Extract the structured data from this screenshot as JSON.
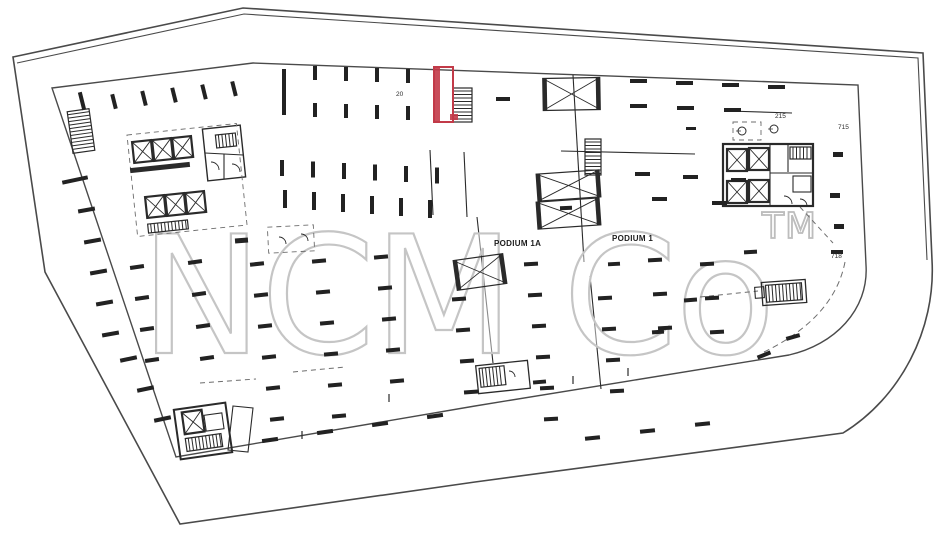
{
  "title": "Podium level floor plan (scanned drawing)",
  "watermark": {
    "text": "NCM Co",
    "tm": "TM"
  },
  "labels": {
    "podium1a": "PODIUM 1A",
    "podium1": "PODIUM 1"
  },
  "colors": {
    "ink": "#2a2a2a",
    "boundary": "#4a4a4a",
    "faint": "#6d6d6d",
    "red": "#c23a48",
    "watermark": "#c5c5c5"
  },
  "tiny_labels": [
    {
      "t": "20",
      "x": 396,
      "y": 96
    },
    {
      "t": "215",
      "x": 775,
      "y": 118
    },
    {
      "t": "715",
      "x": 838,
      "y": 129
    },
    {
      "t": "718",
      "x": 831,
      "y": 258
    }
  ],
  "plan": {
    "outer": "M13,57 L243,8 L923,53 L932,260 C936,330 900,398 843,433 L475,482 L180,524 L45,272 Z",
    "outerDouble": "M17,63 L244,14 L918,58 L927,260",
    "inner": "M52,88 L253,63 L858,85 L866,265 C869,310 834,345 789,355 L475,406 L176,457 Z",
    "aisle_lines": [
      [
        573,
        75,
        584,
        262
      ],
      [
        477,
        217,
        493,
        363
      ],
      [
        590,
        276,
        601,
        389
      ],
      [
        561,
        151,
        695,
        154
      ],
      [
        728,
        111,
        792,
        113
      ],
      [
        430,
        150,
        433,
        215
      ],
      [
        464,
        152,
        467,
        217
      ]
    ],
    "dashed_lines": [
      [
        293,
        372,
        345,
        367
      ],
      [
        200,
        383,
        256,
        379
      ],
      [
        800,
        207,
        833,
        243
      ],
      [
        700,
        297,
        758,
        291
      ],
      [
        736,
        131,
        742,
        131
      ],
      [
        768,
        129,
        774,
        129
      ]
    ],
    "dashed_arc": "M845,262 Q834,318 764,352",
    "stubs": [
      [
        302,
        431,
        302,
        439
      ],
      [
        389,
        394,
        389,
        402
      ],
      [
        573,
        376,
        573,
        384
      ],
      [
        628,
        368,
        628,
        376
      ]
    ],
    "red_room": {
      "x": 434,
      "y": 67,
      "w": 19,
      "h": 55
    },
    "ramps": [
      {
        "x": 543,
        "y": 78,
        "w": 57,
        "h": 32,
        "rot": -1
      },
      {
        "x": 537,
        "y": 172,
        "w": 63,
        "h": 27,
        "rot": -4
      },
      {
        "x": 537,
        "y": 200,
        "w": 63,
        "h": 27,
        "rot": -4
      },
      {
        "x": 455,
        "y": 257,
        "w": 50,
        "h": 30,
        "rot": -8
      }
    ],
    "stairs": [
      {
        "x": 70,
        "y": 110,
        "w": 22,
        "h": 42,
        "rot": -8
      },
      {
        "x": 453,
        "y": 88,
        "w": 19,
        "h": 34,
        "rot": 0
      },
      {
        "x": 585,
        "y": 139,
        "w": 16,
        "h": 36,
        "rot": 0
      },
      {
        "x": 216,
        "y": 134,
        "w": 20,
        "h": 13,
        "rot": -6
      },
      {
        "x": 790,
        "y": 147,
        "w": 21,
        "h": 12,
        "rot": 0
      },
      {
        "x": 480,
        "y": 367,
        "w": 25,
        "h": 19,
        "rot": -6
      },
      {
        "x": 766,
        "y": 284,
        "w": 36,
        "h": 17,
        "rot": -4
      },
      {
        "x": 186,
        "y": 436,
        "w": 36,
        "h": 13,
        "rot": -8
      },
      {
        "x": 148,
        "y": 222,
        "w": 40,
        "h": 9,
        "rot": -6
      }
    ],
    "elevators": [
      {
        "x": 133,
        "y": 141,
        "s": 19,
        "rot": -6
      },
      {
        "x": 153,
        "y": 139,
        "s": 19,
        "rot": -6
      },
      {
        "x": 173,
        "y": 137,
        "s": 19,
        "rot": -6
      },
      {
        "x": 146,
        "y": 196,
        "s": 19,
        "rot": -6
      },
      {
        "x": 166,
        "y": 194,
        "s": 19,
        "rot": -6
      },
      {
        "x": 186,
        "y": 192,
        "s": 19,
        "rot": -6
      },
      {
        "x": 727,
        "y": 149,
        "s": 20,
        "rot": 0
      },
      {
        "x": 749,
        "y": 148,
        "s": 20,
        "rot": 0
      },
      {
        "x": 727,
        "y": 181,
        "s": 20,
        "rot": 0
      },
      {
        "x": 749,
        "y": 180,
        "s": 20,
        "rot": 0
      },
      {
        "x": 183,
        "y": 411,
        "s": 20,
        "rot": -8
      }
    ],
    "rects": [
      {
        "x": 205,
        "y": 127,
        "w": 38,
        "h": 52,
        "rot": -6,
        "sw": 1.4
      },
      {
        "x": 723,
        "y": 144,
        "w": 90,
        "h": 62,
        "rot": 0,
        "sw": 2.2
      },
      {
        "x": 793,
        "y": 176,
        "w": 18,
        "h": 16,
        "rot": 0,
        "sw": 1.1
      },
      {
        "x": 177,
        "y": 406,
        "w": 52,
        "h": 50,
        "rot": -8,
        "sw": 2
      },
      {
        "x": 205,
        "y": 414,
        "w": 18,
        "h": 16,
        "rot": -8,
        "sw": 1.1
      },
      {
        "x": 477,
        "y": 363,
        "w": 52,
        "h": 28,
        "rot": -6,
        "sw": 1.3
      },
      {
        "x": 762,
        "y": 281,
        "w": 44,
        "h": 23,
        "rot": -4,
        "sw": 1.3
      },
      {
        "x": 755,
        "y": 287,
        "w": 9,
        "h": 11,
        "rot": -4,
        "sw": 1.1
      }
    ],
    "dashed_rects": [
      {
        "x": 132,
        "y": 129,
        "w": 110,
        "h": 102,
        "rot": -6
      },
      {
        "x": 733,
        "y": 122,
        "w": 28,
        "h": 18,
        "rot": 0
      },
      {
        "x": 268,
        "y": 226,
        "w": 46,
        "h": 26,
        "rot": -3
      }
    ],
    "detail_lines": [
      [
        205,
        153,
        243,
        155
      ],
      [
        224,
        154,
        224,
        179
      ],
      [
        770,
        144,
        770,
        206
      ],
      [
        770,
        173,
        813,
        173
      ],
      [
        788,
        144,
        788,
        172
      ]
    ],
    "polys": [
      "233,406 253,408 248,452 228,450"
    ],
    "wall_bars": [
      {
        "x": 130,
        "y": 165,
        "w": 60,
        "h": 5,
        "rot": -6
      }
    ],
    "arcs": [
      "M279,237 a7,7 0 0 1 7,7",
      "M301,234 a7,7 0 0 1 7,7",
      "M211,162 a8,8 0 0 1 8,8",
      "M232,164 a8,8 0 0 1 8,8",
      "M784,196 a8,8 0 0 1 8,8",
      "M800,199 a7,7 0 0 1 7,7",
      "M509,371 a6,6 0 0 1 6,6"
    ],
    "fix_circles": [
      {
        "cx": 742,
        "cy": 131,
        "r": 4
      },
      {
        "cx": 774,
        "cy": 129,
        "r": 4
      }
    ],
    "bars": [
      {
        "x": 112,
        "y": 94,
        "n": 5,
        "dx": 30,
        "dy": -3.2,
        "w": 4,
        "h": 15,
        "rot": -14
      },
      {
        "x": 80,
        "y": 92,
        "n": 1,
        "dx": 0,
        "dy": 0,
        "w": 4,
        "h": 18,
        "rot": -14
      },
      {
        "x": 282,
        "y": 69,
        "n": 1,
        "dx": 0,
        "dy": 0,
        "w": 4,
        "h": 46,
        "rot": 0
      },
      {
        "x": 313,
        "y": 66,
        "n": 4,
        "dx": 31,
        "dy": 1,
        "w": 4,
        "h": 14,
        "rot": 0
      },
      {
        "x": 313,
        "y": 103,
        "n": 4,
        "dx": 31,
        "dy": 1,
        "w": 4,
        "h": 14,
        "rot": 0
      },
      {
        "x": 280,
        "y": 160,
        "n": 6,
        "dx": 31,
        "dy": 1.5,
        "w": 4,
        "h": 16,
        "rot": 0
      },
      {
        "x": 283,
        "y": 190,
        "n": 6,
        "dx": 29,
        "dy": 2,
        "w": 4,
        "h": 18,
        "rot": 0
      }
    ],
    "dashes": [
      {
        "x": 78,
        "y": 208,
        "n": 5,
        "dx": 6,
        "dy": 31,
        "w": 17,
        "h": 4,
        "rot": -10
      },
      {
        "x": 120,
        "y": 357,
        "n": 3,
        "dx": 17,
        "dy": 30,
        "w": 17,
        "h": 4,
        "rot": -12
      },
      {
        "x": 130,
        "y": 265,
        "n": 4,
        "dx": 5,
        "dy": 31,
        "w": 14,
        "h": 4,
        "rot": -8
      },
      {
        "x": 188,
        "y": 260,
        "n": 4,
        "dx": 4,
        "dy": 32,
        "w": 14,
        "h": 4,
        "rot": -8
      },
      {
        "x": 250,
        "y": 262,
        "n": 6,
        "dx": 4,
        "dy": 31,
        "w": 14,
        "h": 4,
        "rot": -6
      },
      {
        "x": 312,
        "y": 259,
        "n": 6,
        "dx": 4,
        "dy": 31,
        "w": 14,
        "h": 4,
        "rot": -5
      },
      {
        "x": 374,
        "y": 255,
        "n": 5,
        "dx": 4,
        "dy": 31,
        "w": 14,
        "h": 4,
        "rot": -5
      },
      {
        "x": 452,
        "y": 297,
        "n": 4,
        "dx": 4,
        "dy": 31,
        "w": 14,
        "h": 4,
        "rot": -4
      },
      {
        "x": 524,
        "y": 262,
        "n": 6,
        "dx": 4,
        "dy": 31,
        "w": 14,
        "h": 4,
        "rot": -3
      },
      {
        "x": 598,
        "y": 296,
        "n": 4,
        "dx": 4,
        "dy": 31,
        "w": 14,
        "h": 4,
        "rot": -3
      },
      {
        "x": 648,
        "y": 258,
        "n": 3,
        "dx": 5,
        "dy": 34,
        "w": 14,
        "h": 4,
        "rot": -3
      },
      {
        "x": 700,
        "y": 262,
        "n": 3,
        "dx": 5,
        "dy": 34,
        "w": 14,
        "h": 4,
        "rot": -3
      },
      {
        "x": 630,
        "y": 79,
        "n": 4,
        "dx": 46,
        "dy": 2,
        "w": 17,
        "h": 4,
        "rot": 0
      },
      {
        "x": 630,
        "y": 104,
        "n": 3,
        "dx": 47,
        "dy": 2,
        "w": 17,
        "h": 4,
        "rot": 0
      },
      {
        "x": 635,
        "y": 172,
        "n": 3,
        "dx": 48,
        "dy": 3,
        "w": 15,
        "h": 4,
        "rot": 0
      },
      {
        "x": 652,
        "y": 197,
        "n": 2,
        "dx": 60,
        "dy": 4,
        "w": 15,
        "h": 4,
        "rot": 0
      },
      {
        "x": 262,
        "y": 438,
        "n": 4,
        "dx": 55,
        "dy": -8,
        "w": 16,
        "h": 4,
        "rot": -8
      },
      {
        "x": 585,
        "y": 436,
        "n": 3,
        "dx": 55,
        "dy": -7,
        "w": 15,
        "h": 4,
        "rot": -6
      }
    ],
    "singles": [
      [
        62,
        178,
        26,
        4,
        -12
      ],
      [
        235,
        238,
        13,
        5,
        -4
      ],
      [
        496,
        97,
        14,
        4,
        0
      ],
      [
        686,
        127,
        10,
        3,
        0
      ],
      [
        833,
        152,
        10,
        5,
        0
      ],
      [
        830,
        193,
        10,
        5,
        0
      ],
      [
        834,
        224,
        10,
        5,
        0
      ],
      [
        831,
        250,
        12,
        4,
        0
      ],
      [
        757,
        353,
        14,
        4,
        -22
      ],
      [
        786,
        335,
        14,
        4,
        -16
      ],
      [
        744,
        250,
        13,
        4,
        -3
      ],
      [
        684,
        298,
        13,
        4,
        -4
      ],
      [
        652,
        330,
        12,
        4,
        -4
      ],
      [
        608,
        262,
        12,
        4,
        -3
      ],
      [
        560,
        206,
        12,
        4,
        -2
      ],
      [
        533,
        380,
        13,
        4,
        -5
      ]
    ]
  }
}
